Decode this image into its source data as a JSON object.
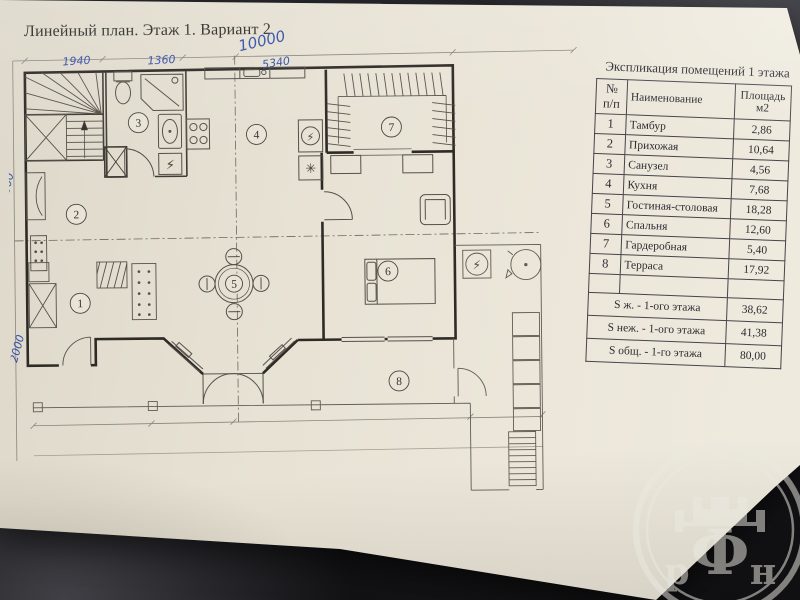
{
  "page": {
    "title": "Линейный план. Этаж 1. Вариант 2"
  },
  "handwriting": {
    "ink_color": "#3450a8",
    "total_width": "10000",
    "dim_left": "1940",
    "dim_mid": "1360",
    "dim_right": "5340",
    "side_upper": "6000",
    "side_lower": "2000"
  },
  "plan": {
    "rooms": [
      {
        "number": "1"
      },
      {
        "number": "2"
      },
      {
        "number": "3"
      },
      {
        "number": "4"
      },
      {
        "number": "5"
      },
      {
        "number": "6"
      },
      {
        "number": "7"
      },
      {
        "number": "8"
      }
    ],
    "symbols": {
      "electric": "⚡",
      "fridge": "✳"
    }
  },
  "table": {
    "title": "Экспликация помещений 1 этажа",
    "columns": {
      "num": "№ п/п",
      "name": "Наименование",
      "area": "Площадь м2"
    },
    "rows": [
      {
        "num": "1",
        "name": "Тамбур",
        "area": "2,86"
      },
      {
        "num": "2",
        "name": "Прихожая",
        "area": "10,64"
      },
      {
        "num": "3",
        "name": "Санузел",
        "area": "4,56"
      },
      {
        "num": "4",
        "name": "Кухня",
        "area": "7,68"
      },
      {
        "num": "5",
        "name": "Гостиная-столовая",
        "area": "18,28"
      },
      {
        "num": "6",
        "name": "Спальня",
        "area": "12,60"
      },
      {
        "num": "7",
        "name": "Гардеробная",
        "area": "5,40"
      },
      {
        "num": "8",
        "name": "Терраса",
        "area": "17,92"
      }
    ],
    "totals": [
      {
        "label": "S ж. - 1-ого этажа",
        "value": "38,62"
      },
      {
        "label": "S неж. - 1-ого этажа",
        "value": "41,38"
      },
      {
        "label": "S общ. - 1-го этажа",
        "value": "80,00"
      }
    ]
  },
  "watermark": {
    "left": "р",
    "center": "Ф",
    "right": "н"
  }
}
